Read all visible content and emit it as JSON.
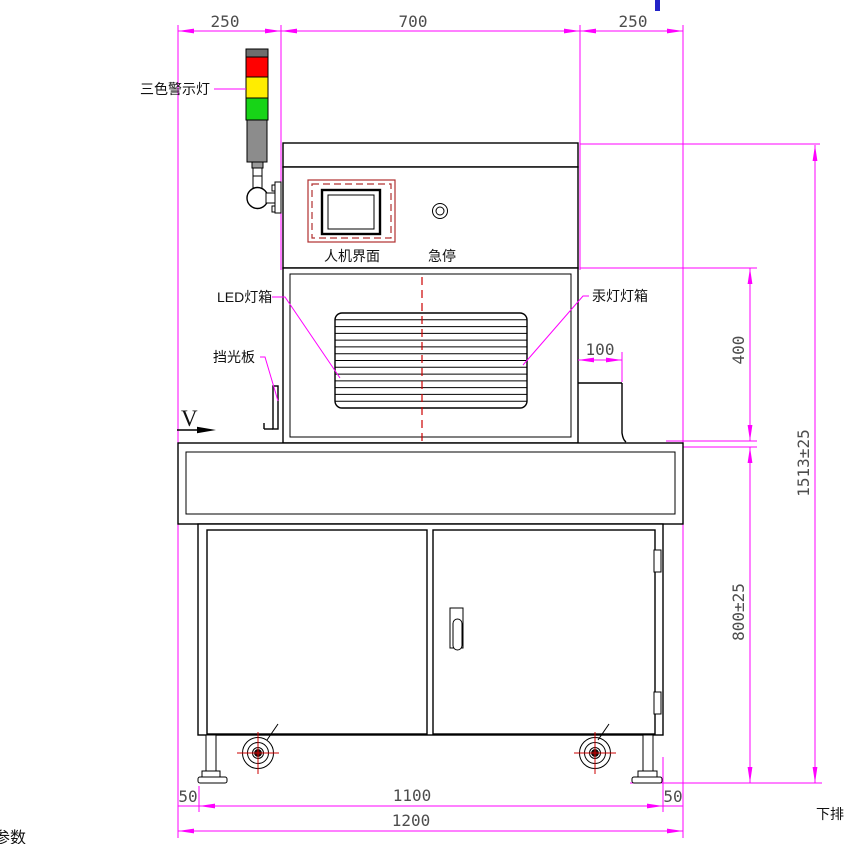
{
  "title": "机器设备正视图工程图纸",
  "labels": {
    "tower_light": "三色警示灯",
    "hmi_screen": "人机界面",
    "emergency_stop": "急停",
    "led_lightbox": "LED灯箱",
    "mercury_lightbox": "汞灯灯箱",
    "light_shield": "挡光板",
    "view_marker": "V",
    "bottom_right_note": "下排",
    "bottom_left_partial": "参数"
  },
  "dimensions": {
    "top_left": "250",
    "top_center": "700",
    "top_right": "250",
    "bracket_width": "100",
    "upper_section_height": "400",
    "table_height": "800±25",
    "overall_height": "1513±25",
    "inner_span": "1100",
    "margin_left": "50",
    "margin_right": "50",
    "overall_width": "1200"
  },
  "colors": {
    "dimension_lines": "#ff00ff",
    "dimension_text": "#4d4d4d",
    "structure": "#000000",
    "centerline": "#cc0000",
    "hmi_bezel": "#b03030",
    "tower_red": "#ff0000",
    "tower_yellow": "#ffed00",
    "tower_green": "#17d417",
    "tower_gray": "#8c8c8c",
    "caster_crosshair": "#cc0000",
    "blue_mark": "#2323c8"
  }
}
